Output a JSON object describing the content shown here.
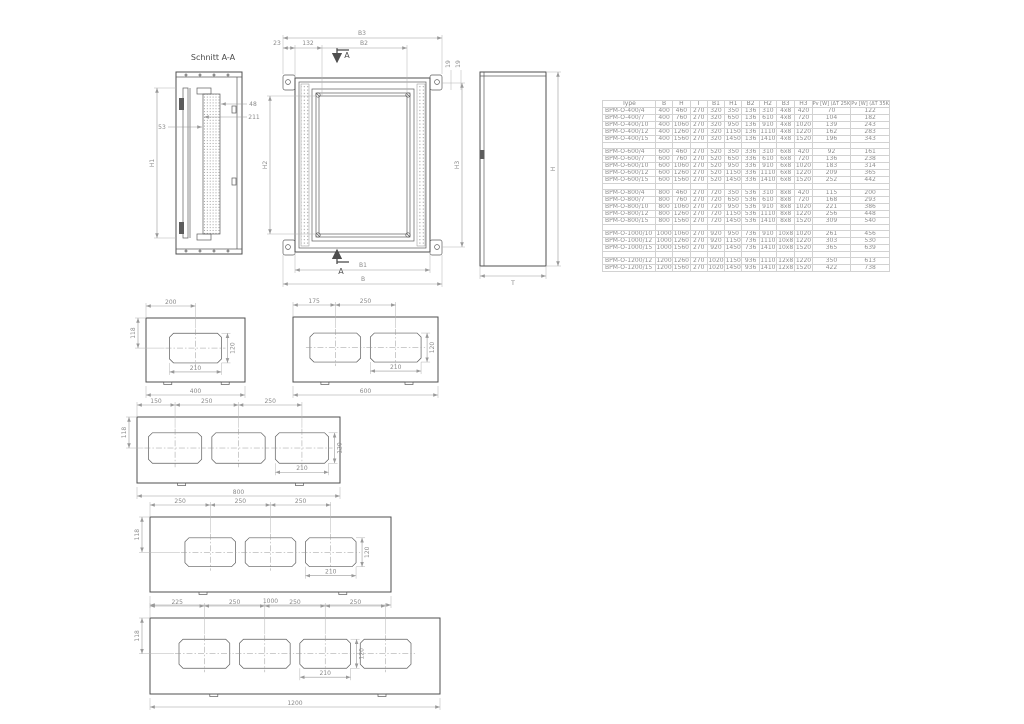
{
  "drawing": {
    "section_view": {
      "title": "Schnitt A-A",
      "d48": "48",
      "d211": "211",
      "d53": "53",
      "h1": "H1"
    },
    "front_view": {
      "b3": "B3",
      "d23": "23",
      "d132": "132",
      "b2": "B2",
      "section_label_top": "A",
      "section_label_bottom": "A",
      "d19a": "19",
      "d19b": "19",
      "h2": "H2",
      "h3": "H3",
      "b1": "B1",
      "b": "B"
    },
    "side_view": {
      "h": "H",
      "t": "T"
    },
    "plates": [
      {
        "overall_mm": 400,
        "overall_label": "400",
        "centers_mm": [
          200
        ],
        "top_labels": [
          "200"
        ],
        "left_label": "118",
        "cutout_w_mm": 210,
        "cutout_h_mm": 120,
        "cutout_w_label": "210",
        "cutout_h_label": "120"
      },
      {
        "overall_mm": 600,
        "overall_label": "600",
        "centers_mm": [
          175,
          425
        ],
        "top_labels": [
          "175",
          "250"
        ],
        "left_label": null,
        "cutout_w_mm": 210,
        "cutout_h_mm": 120,
        "cutout_w_label": "210",
        "cutout_h_label": "120"
      },
      {
        "overall_mm": 800,
        "overall_label": "800",
        "centers_mm": [
          150,
          400,
          650
        ],
        "top_labels": [
          "150",
          "250",
          "250"
        ],
        "left_label": "118",
        "cutout_w_mm": 210,
        "cutout_h_mm": 120,
        "cutout_w_label": "210",
        "cutout_h_label": "120"
      },
      {
        "overall_mm": 1000,
        "overall_label": "1000",
        "centers_mm": [
          250,
          500,
          750
        ],
        "top_labels": [
          "250",
          "250",
          "250"
        ],
        "left_label": "118",
        "cutout_w_mm": 210,
        "cutout_h_mm": 120,
        "cutout_w_label": "210",
        "cutout_h_label": "120"
      },
      {
        "overall_mm": 1200,
        "overall_label": "1200",
        "centers_mm": [
          225,
          475,
          725,
          975
        ],
        "top_labels": [
          "225",
          "250",
          "250",
          "250"
        ],
        "left_label": "118",
        "cutout_w_mm": 210,
        "cutout_h_mm": 120,
        "cutout_w_label": "210",
        "cutout_h_label": "120"
      }
    ]
  },
  "table": {
    "headers": [
      "Type",
      "B",
      "H",
      "T",
      "B1",
      "H1",
      "B2",
      "H2",
      "B3",
      "H3",
      "Pv [W] (ΔT 25K)",
      "Pv [W] (ΔT 35K)"
    ],
    "groups": [
      {
        "rows": [
          [
            "BPM-O-400/4",
            "400",
            "460",
            "270",
            "320",
            "350",
            "136",
            "310",
            "4x8",
            "420",
            "70",
            "122"
          ],
          [
            "BPM-O-400/7",
            "400",
            "760",
            "270",
            "320",
            "650",
            "136",
            "610",
            "4x8",
            "720",
            "104",
            "182"
          ],
          [
            "BPM-O-400/10",
            "400",
            "1060",
            "270",
            "320",
            "950",
            "136",
            "910",
            "4x8",
            "1020",
            "139",
            "243"
          ],
          [
            "BPM-O-400/12",
            "400",
            "1260",
            "270",
            "320",
            "1150",
            "136",
            "1110",
            "4x8",
            "1220",
            "162",
            "283"
          ],
          [
            "BPM-O-400/15",
            "400",
            "1560",
            "270",
            "320",
            "1450",
            "136",
            "1410",
            "4x8",
            "1520",
            "196",
            "343"
          ]
        ]
      },
      {
        "rows": [
          [
            "BPM-O-600/4",
            "600",
            "460",
            "270",
            "520",
            "350",
            "336",
            "310",
            "6x8",
            "420",
            "92",
            "161"
          ],
          [
            "BPM-O-600/7",
            "600",
            "760",
            "270",
            "520",
            "650",
            "336",
            "610",
            "6x8",
            "720",
            "136",
            "238"
          ],
          [
            "BPM-O-600/10",
            "600",
            "1060",
            "270",
            "520",
            "950",
            "336",
            "910",
            "6x8",
            "1020",
            "183",
            "314"
          ],
          [
            "BPM-O-600/12",
            "600",
            "1260",
            "270",
            "520",
            "1150",
            "336",
            "1110",
            "6x8",
            "1220",
            "209",
            "365"
          ],
          [
            "BPM-O-600/15",
            "600",
            "1560",
            "270",
            "520",
            "1450",
            "336",
            "1410",
            "6x8",
            "1520",
            "252",
            "442"
          ]
        ]
      },
      {
        "rows": [
          [
            "BPM-O-800/4",
            "800",
            "460",
            "270",
            "720",
            "350",
            "536",
            "310",
            "8x8",
            "420",
            "115",
            "200"
          ],
          [
            "BPM-O-800/7",
            "800",
            "760",
            "270",
            "720",
            "650",
            "536",
            "610",
            "8x8",
            "720",
            "168",
            "293"
          ],
          [
            "BPM-O-800/10",
            "800",
            "1060",
            "270",
            "720",
            "950",
            "536",
            "910",
            "8x8",
            "1020",
            "221",
            "386"
          ],
          [
            "BPM-O-800/12",
            "800",
            "1260",
            "270",
            "720",
            "1150",
            "536",
            "1110",
            "8x8",
            "1220",
            "256",
            "448"
          ],
          [
            "BPM-O-800/15",
            "800",
            "1560",
            "270",
            "720",
            "1450",
            "536",
            "1410",
            "8x8",
            "1520",
            "309",
            "540"
          ]
        ]
      },
      {
        "rows": [
          [
            "BPM-O-1000/10",
            "1000",
            "1060",
            "270",
            "920",
            "950",
            "736",
            "910",
            "10x8",
            "1020",
            "261",
            "456"
          ],
          [
            "BPM-O-1000/12",
            "1000",
            "1260",
            "270",
            "920",
            "1150",
            "736",
            "1110",
            "10x8",
            "1220",
            "303",
            "530"
          ],
          [
            "BPM-O-1000/15",
            "1000",
            "1560",
            "270",
            "920",
            "1450",
            "736",
            "1410",
            "10x8",
            "1520",
            "365",
            "639"
          ]
        ]
      },
      {
        "rows": [
          [
            "BPM-O-1200/12",
            "1200",
            "1260",
            "270",
            "1020",
            "1150",
            "936",
            "1110",
            "12x8",
            "1220",
            "350",
            "613"
          ],
          [
            "BPM-O-1200/15",
            "1200",
            "1560",
            "270",
            "1020",
            "1450",
            "936",
            "1410",
            "12x8",
            "1520",
            "422",
            "738"
          ]
        ]
      }
    ]
  }
}
